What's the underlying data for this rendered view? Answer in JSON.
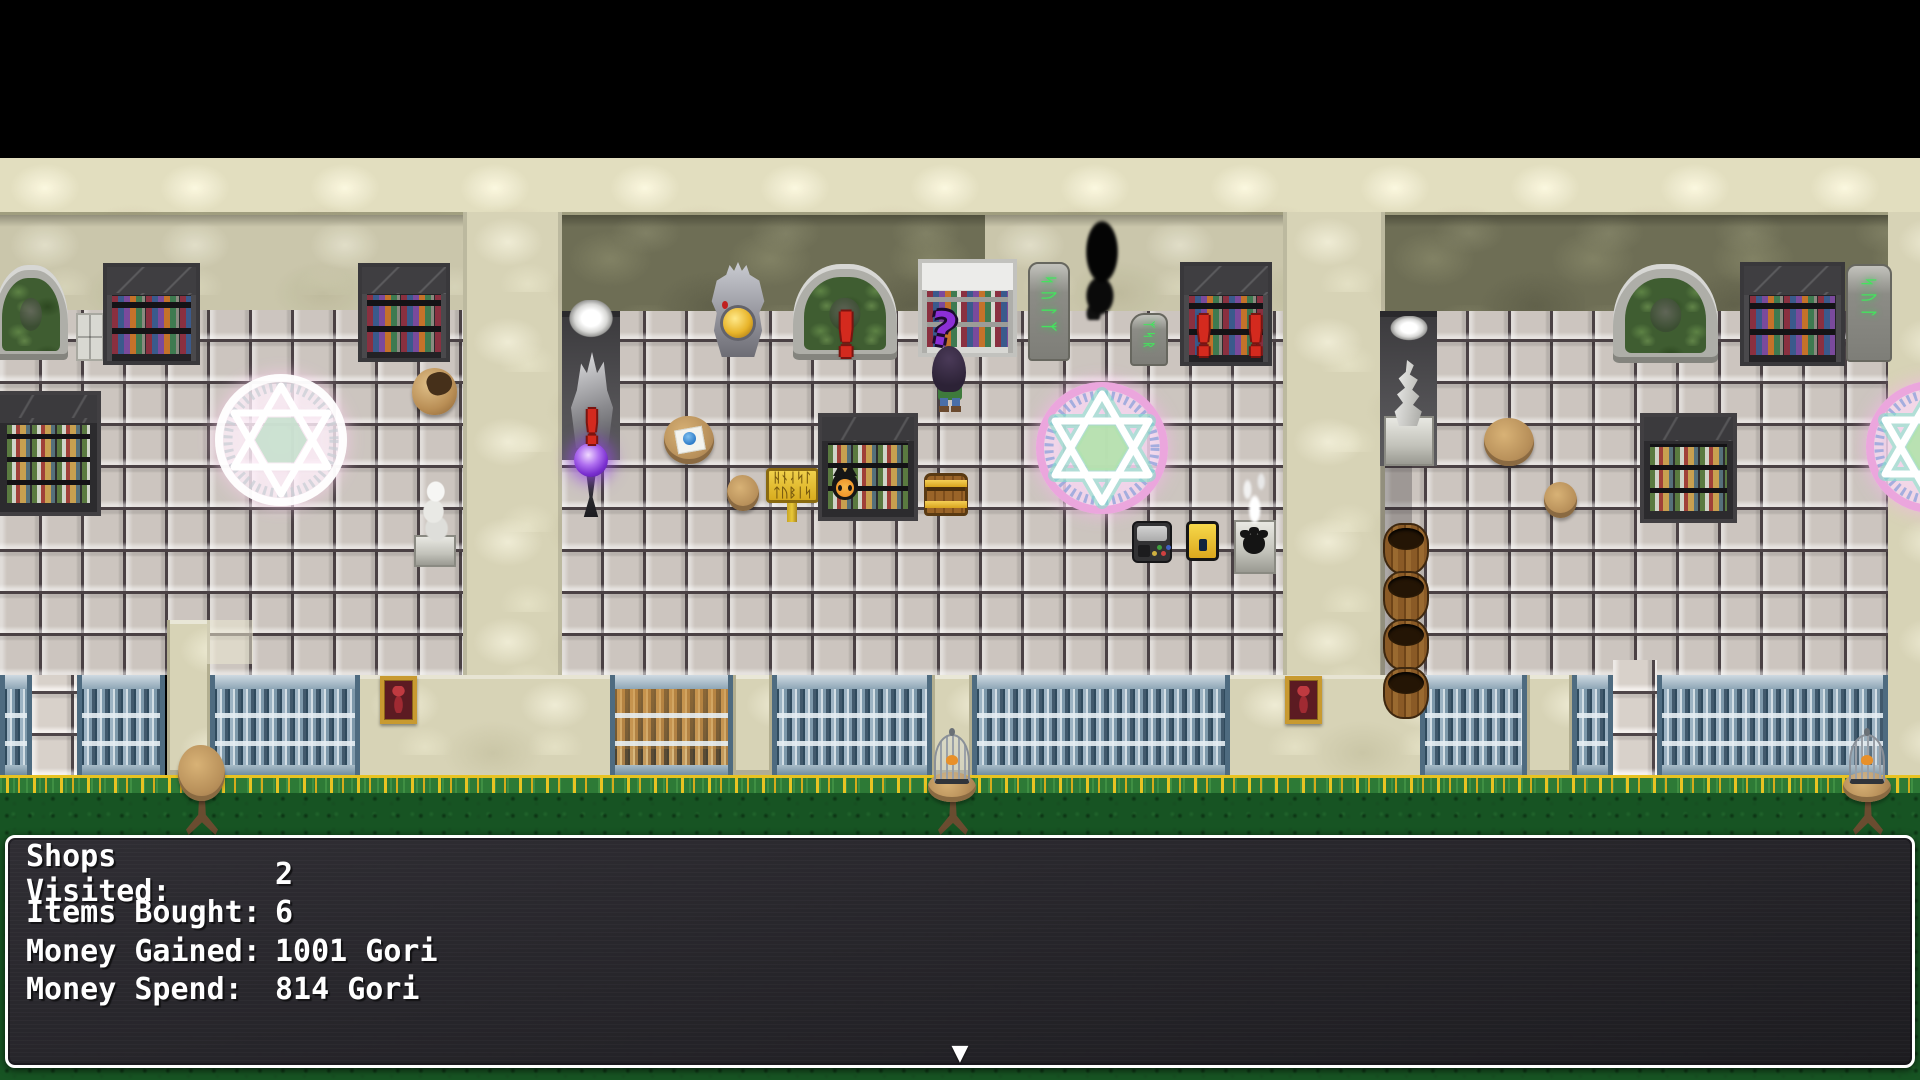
{
  "dialog": {
    "rows": [
      {
        "label": "Shops Visited:",
        "value": "2"
      },
      {
        "label": "Items Bought:",
        "value": "6"
      },
      {
        "label": "Money Gained:",
        "value": "1001 Gori"
      },
      {
        "label": "Money Spend:",
        "value": "814 Gori"
      }
    ],
    "continue_indicator": "▼"
  },
  "indicators": {
    "event_exclamation": "!",
    "player_question": "?"
  },
  "decor": {
    "stele_runes_1": "ᛋᚢᛚᛉ",
    "stele_runes_2": "ᛉᛋᚱ",
    "stele_runes_3": "ᛋᚢᛚ",
    "sign_line_1": "ᚺᚾᛆᛋᛚ",
    "sign_line_2": "ᛏᚢᛒᛁᛋ"
  },
  "colors": {
    "dialog_bg": "#2a272c",
    "dialog_border": "#ffffff",
    "event_alert_red": "#d42a1e",
    "player_query_purple": "#8b2fd6",
    "magic_glow_pink": "#f2b6e6",
    "hexagram_white": "#ffffff",
    "hex_center_green": "#b2e2ac",
    "wall_olive": "#6e6e55",
    "wall_beige": "#d7d3b6",
    "floor_tile": "#ccc5bf",
    "fence_steel": "#8fa7b9",
    "grass_green": "#175423",
    "flower_gold": "#e8c322",
    "sign_yellow": "#e9c832"
  },
  "scene_objects": [
    "magic-circle",
    "bookshelf",
    "potion-shelf",
    "green-arch-relief",
    "rune-stele",
    "shadow-ghost",
    "treasure-chest",
    "yellow-chest",
    "game-console",
    "barrel-stack",
    "birdcage-table",
    "framed-picture",
    "crystal-torch",
    "purple-orb-lamp",
    "dragon-statue",
    "paw-pedestal",
    "smoke-statue",
    "egg-shell",
    "sign-post",
    "round-table",
    "stool",
    "player-witch"
  ]
}
